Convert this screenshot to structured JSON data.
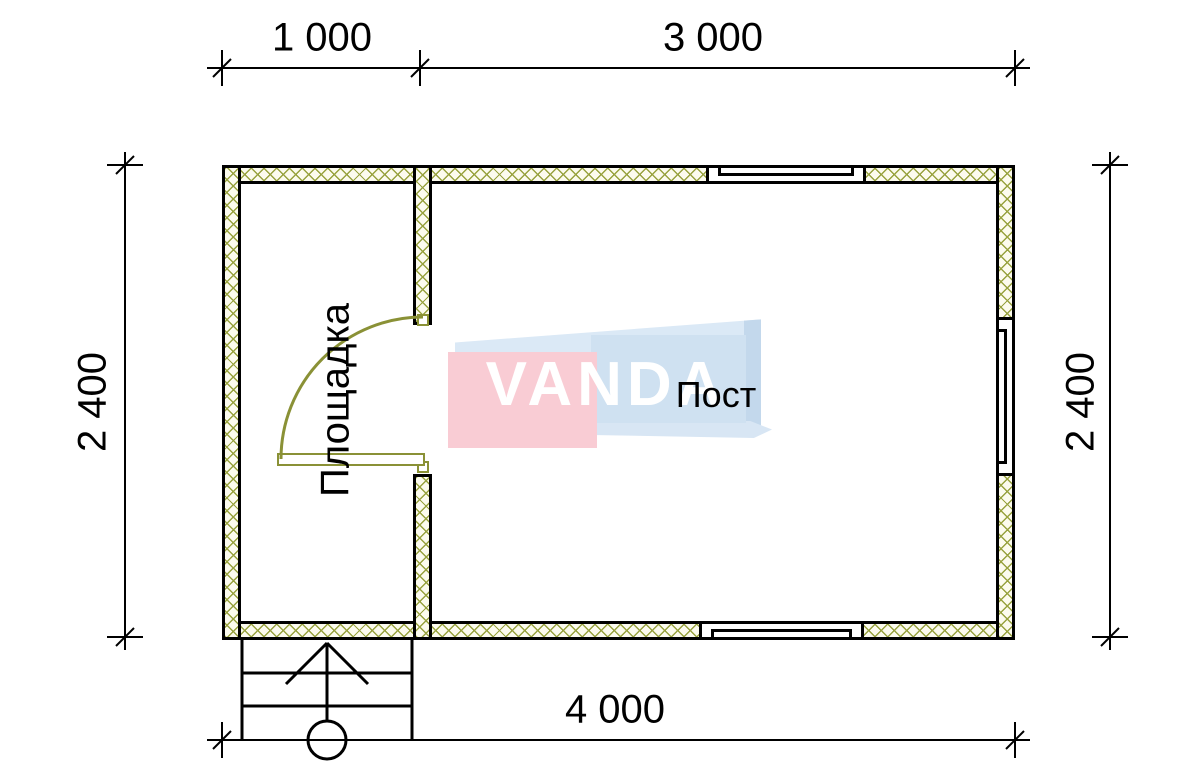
{
  "drawing": {
    "type": "floor-plan",
    "dimensions": {
      "top_segment_1": "1 000",
      "top_segment_2": "3 000",
      "left_height": "2 400",
      "right_height": "2 400",
      "bottom_width": "4 000"
    },
    "rooms": {
      "entrance": "Площадка",
      "main": "Пост"
    },
    "watermark": {
      "brand": "VANDA"
    },
    "colors": {
      "wall_hatch": "#98a23f",
      "door": "#8a9136",
      "outline": "#000000",
      "logo_pink": "#f9ccd4",
      "logo_blue": "#cfe1f1"
    }
  }
}
